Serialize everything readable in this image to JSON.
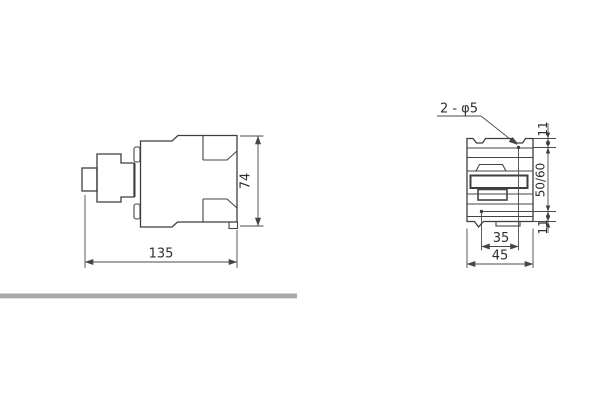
{
  "page": {
    "background_color": "#ffffff",
    "divider_color": "#a8a8a8",
    "line_color": "#3e3e3e"
  },
  "drawing": {
    "side_view": {
      "overall_width_label": "135",
      "overall_height_label": "74"
    },
    "front_view": {
      "holes_callout_label": "2 - φ5",
      "hole_spacing_horizontal_label": "35",
      "overall_width_label": "45",
      "top_edge_to_hole_label": "11",
      "hole_spacing_vertical_label": "50/60",
      "hole_to_bottom_edge_label": "11"
    }
  }
}
